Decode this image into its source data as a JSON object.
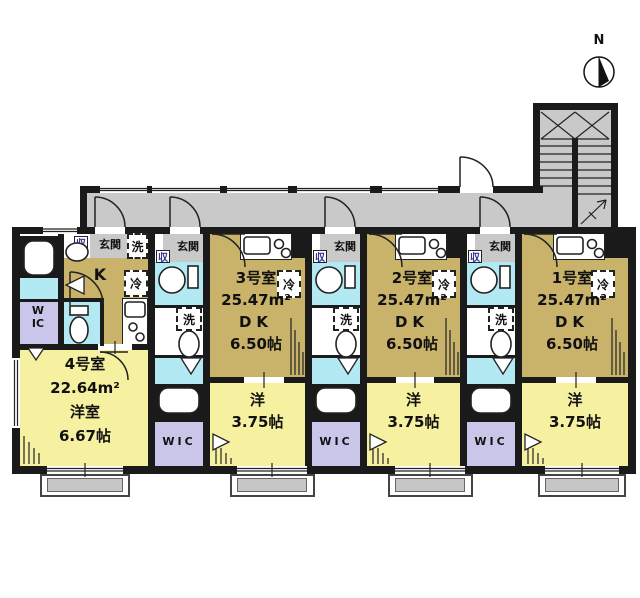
{
  "compass": {
    "north": "N"
  },
  "labels": {
    "entrance": "玄関",
    "storage": "収",
    "laundry": "洗",
    "fridge": "冷",
    "kitchen": "K",
    "closet": "WIC"
  },
  "units": [
    {
      "name": "1号室",
      "area": "25.47m²",
      "dining_label": "DK",
      "dining_size": "6.50帖",
      "bedroom_label": "洋",
      "bedroom_size": "3.75帖"
    },
    {
      "name": "2号室",
      "area": "25.47m²",
      "dining_label": "DK",
      "dining_size": "6.50帖",
      "bedroom_label": "洋",
      "bedroom_size": "3.75帖"
    },
    {
      "name": "3号室",
      "area": "25.47m²",
      "dining_label": "DK",
      "dining_size": "6.50帖",
      "bedroom_label": "洋",
      "bedroom_size": "3.75帖"
    },
    {
      "name": "4号室",
      "area": "22.64m²",
      "bedroom_label": "洋室",
      "bedroom_size": "6.67帖"
    }
  ],
  "colors": {
    "wall": "#1a1a1a",
    "corridor": "#c9c9c9",
    "dining_kitchen": "#c9b26a",
    "bedroom": "#f5f1a1",
    "wet_area": "#b2e9f2",
    "closet": "#c9c6ea",
    "balcony": "#c6c6c6",
    "storage_text": "#333399"
  }
}
